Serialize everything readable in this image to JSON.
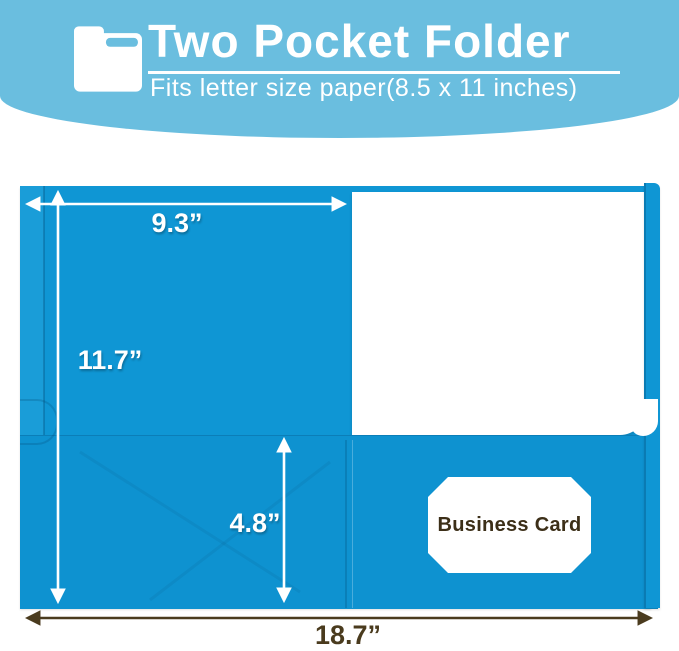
{
  "header": {
    "title": "Two Pocket Folder",
    "subtitle": "Fits letter size paper(8.5 x 11 inches)",
    "icon": "folder-icon",
    "colors": {
      "background": "#6ABEDF",
      "text": "#FFFFFF"
    }
  },
  "folder": {
    "color": "#0F96D4",
    "business_card_label": "Business Card"
  },
  "dimensions": {
    "pocket_width": "9.3”",
    "folder_height": "11.7”",
    "pocket_depth": "4.8”",
    "total_open_width": "18.7”",
    "white_arrow_color": "#FFFFFF",
    "dark_arrow_color": "#4A3B1E"
  }
}
